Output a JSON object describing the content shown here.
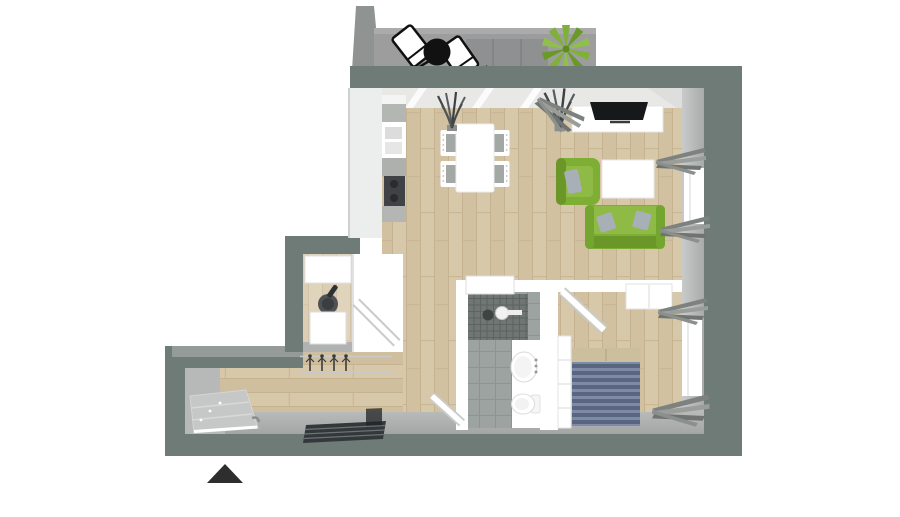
{
  "meta": {
    "type": "3d-floor-plan-rendering",
    "description": "Top-down 3D rendered floor plan of a one-bedroom apartment with balcony, living/dining room with kitchenette, storage room, hallway, bathroom and bedroom",
    "canvas": {
      "width": 900,
      "height": 517
    }
  },
  "colors": {
    "background": "#ffffff",
    "wall_exterior": "#6e7b76",
    "wall_face_light": "#b3b6b4",
    "wall_top_light": "#949b98",
    "wall_interior_white": "#ffffff",
    "floor_wood": "#d8c8aa",
    "floor_wood_line": "#c4b291",
    "balcony_floor": "#9c9d9c",
    "balcony_wall": "#8f9492",
    "tile_floor": "#9da3a0",
    "shower_mosaic": "#707673",
    "sofa_green": "#7fae34",
    "sofa_green_light": "#8fba46",
    "sofa_green_dark": "#6a9727",
    "pillow_gray": "#a7b0b6",
    "bed_stripe_dark": "#5a6680",
    "bed_stripe_light": "#7d8ba6",
    "bed_pillow_tan": "#ccbf9e",
    "plant_green": "#7fb136",
    "grass_dark": "#4a4f4c",
    "tv_black": "#17181a",
    "cooktop_dark": "#3f4345",
    "counter_gray": "#b4b6b4",
    "doormat_dark": "#33383b",
    "arrow_black": "#2e2e2e",
    "curtain_gray": "#8b908d"
  },
  "compass": {
    "shape": "triangle-up",
    "position": "bottom-left"
  },
  "rooms": [
    {
      "name": "balcony",
      "items": [
        "divider-wall",
        "concrete-floor",
        "outdoor-couch",
        "lounge-chair",
        "lounge-chair",
        "round-black-table",
        "potted-green-plant"
      ]
    },
    {
      "name": "living-dining-room",
      "items": [
        "kitchen-counter",
        "kitchen-sink",
        "cooktop",
        "dining-table",
        "dining-chair",
        "dining-chair",
        "dining-chair",
        "dining-chair",
        "tv-sideboard",
        "flatscreen-tv",
        "green-armchair",
        "white-coffee-table",
        "green-sofa",
        "gray-pillows",
        "tall-grass-plant",
        "tall-grass-plant",
        "window",
        "curtains"
      ]
    },
    {
      "name": "storage-room",
      "items": [
        "white-cabinet",
        "dark-appliance",
        "washing-machine",
        "open-door"
      ]
    },
    {
      "name": "hallway",
      "items": [
        "coat-hooks",
        "dark-doormat-stairs",
        "entrance-stairs",
        "north-arrow"
      ]
    },
    {
      "name": "bathroom",
      "items": [
        "mosaic-shower",
        "floor-drain",
        "shower-fixture",
        "wall-cabinet",
        "washbasin",
        "toilet",
        "open-door"
      ]
    },
    {
      "name": "bedroom",
      "items": [
        "double-bed-striped-duvet",
        "bed-pillows",
        "bedside-shelf",
        "wardrobe",
        "open-door",
        "window",
        "curtains"
      ]
    }
  ]
}
